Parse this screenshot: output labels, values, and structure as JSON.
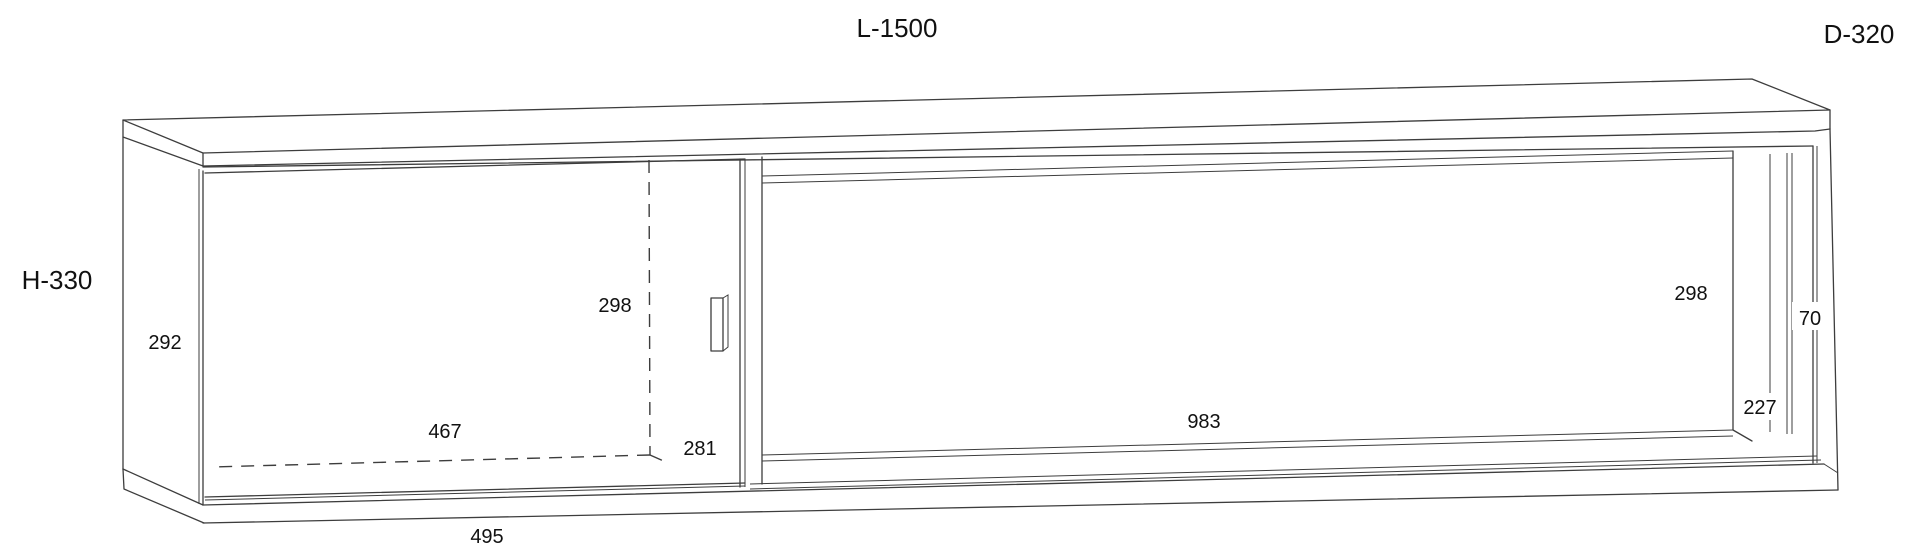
{
  "drawing": {
    "type": "furniture-dimension-drawing",
    "subject": "wall-mounted cabinet with sliding door, axonometric view",
    "background": "#ffffff",
    "line_color": "#3d3d3d",
    "text_color": "#111111",
    "overall_dimensions": {
      "length": "L-1500",
      "depth": "D-320",
      "height": "H-330"
    },
    "detail_dimensions": {
      "left_side_panel_height": "292",
      "door_interior_height": "298",
      "door_interior_width": "467",
      "door_bottom_width": "281",
      "door_outer_width": "495",
      "right_opening_height": "298",
      "right_edge_clearance": "70",
      "right_inner_depth": "227",
      "right_opening_width": "983"
    }
  }
}
